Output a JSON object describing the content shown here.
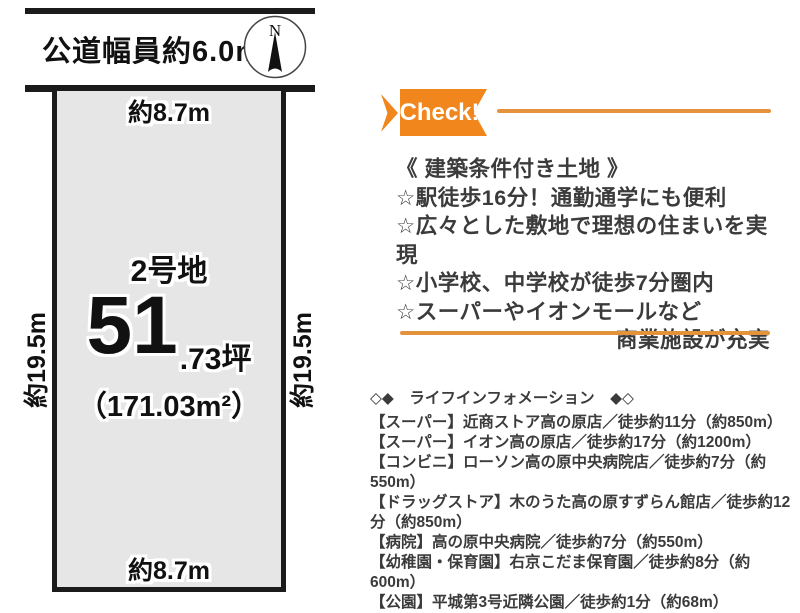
{
  "diagram": {
    "road_label": "公道幅員約6.0m",
    "compass_n": "N",
    "top_width": "約8.7m",
    "bottom_width": "約8.7m",
    "left_depth": "約19.5m",
    "right_depth": "約19.5m",
    "lot_name": "2号地",
    "area_tsubo_main": "51",
    "area_tsubo_rest": ".73坪",
    "area_sqm": "（171.03m²）"
  },
  "check": {
    "label": "Check!"
  },
  "features": {
    "title": "《 建築条件付き土地 》",
    "items": [
      "☆駅徒歩16分！通勤通学にも便利",
      "☆広々とした敷地で理想の住まいを実現",
      "☆小学校、中学校が徒歩7分圏内",
      "☆スーパーやイオンモールなど"
    ],
    "continuation": "商業施設が充実"
  },
  "life_info": {
    "title": "◇◆　ライフインフォメーション　◆◇",
    "items": [
      "【スーパー】近商ストア高の原店／徒歩約11分（約850m）",
      "【スーパー】イオン高の原店／徒歩約17分（約1200m）",
      "【コンビニ】ローソン高の原中央病院店／徒歩約7分（約550m）",
      "【ドラッグストア】木のうた高の原すずらん館店／徒歩約12分（約850m）",
      "【病院】高の原中央病院／徒歩約7分（約550m）",
      "【幼稚園・保育園】右京こだま保育園／徒歩約8分（約600m）",
      "【公園】平城第3号近隣公園／徒歩約1分（約68m）"
    ]
  },
  "colors": {
    "accent_orange": "#f0861c",
    "line_orange": "#e5923c",
    "plot_fill": "#e6e6e6",
    "text_dark": "#3b3b3b"
  }
}
